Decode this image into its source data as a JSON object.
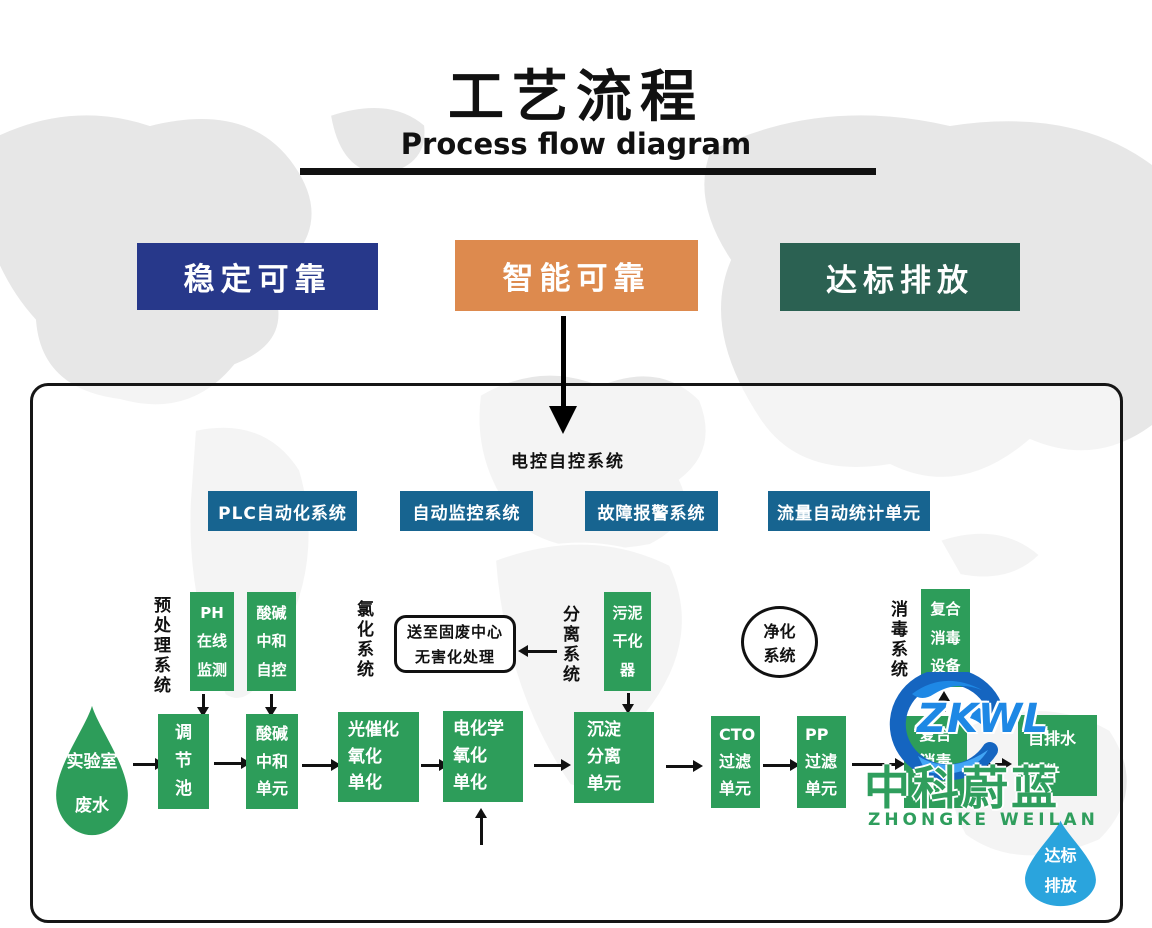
{
  "header": {
    "title": "工艺流程",
    "subtitle": "Process flow diagram"
  },
  "banners": [
    {
      "label": "稳定可靠"
    },
    {
      "label": "智能可靠"
    },
    {
      "label": "达标排放"
    }
  ],
  "control": {
    "label": "电控自控系统",
    "buttons": [
      {
        "label": "PLC自动化系统"
      },
      {
        "label": "自动监控系统"
      },
      {
        "label": "故障报警系统"
      },
      {
        "label": "流量自动统计单元"
      }
    ]
  },
  "section_labels": {
    "pretreatment": "预处理系统",
    "chlorination": "氯化系统",
    "separation": "分离系统",
    "disinfection": "消毒系统"
  },
  "aux_boxes": {
    "ph_monitor": {
      "lines": [
        "PH",
        "在线",
        "监测"
      ]
    },
    "acid_base_auto": {
      "lines": [
        "酸碱",
        "中和",
        "自控"
      ]
    },
    "solid_waste_note": {
      "lines": [
        "送至固废中心",
        "无害化处理"
      ]
    },
    "sludge_dryer": {
      "lines": [
        "污泥",
        "干化",
        "器"
      ]
    },
    "purification_circle": {
      "lines": [
        "净化",
        "系统"
      ]
    },
    "composite_equipment": {
      "lines": [
        "复合",
        "消毒",
        "设备"
      ]
    }
  },
  "flow": {
    "source_drop": {
      "lines": [
        "实验室",
        "废水"
      ]
    },
    "boxes": [
      {
        "lines": [
          "调",
          "节",
          "池"
        ]
      },
      {
        "lines": [
          "酸碱",
          "中和",
          "单元"
        ]
      },
      {
        "lines": [
          "光催化",
          "氧化",
          "单化"
        ]
      },
      {
        "lines": [
          "电化学",
          "氧化",
          "单化"
        ]
      },
      {
        "lines": [
          "沉淀",
          "分离",
          "单元"
        ]
      },
      {
        "lines": [
          "CTO",
          "过滤",
          "单元"
        ]
      },
      {
        "lines": [
          "PP",
          "过滤",
          "单元"
        ]
      },
      {
        "lines": [
          "复合",
          "消毒",
          "单元"
        ]
      },
      {
        "lines": [
          "自排水",
          "组件"
        ]
      }
    ],
    "outlet_drop": {
      "lines": [
        "达标",
        "排放"
      ]
    }
  },
  "watermark": {
    "logo_text": "ZKWL",
    "name_cn": "中科蔚蓝",
    "name_en": "ZHONGKE WEILAN"
  },
  "colors": {
    "banner_blue": "#27388a",
    "banner_orange": "#dd8a4e",
    "banner_green": "#2b6152",
    "button_teal": "#176490",
    "box_green": "#2d9d5a",
    "drop_blue": "#2aa4dd",
    "logo_blue": "#1e88e5",
    "brand_green": "#2f9e5d",
    "ink": "#111111",
    "map_gray": "#e7e7e7"
  }
}
